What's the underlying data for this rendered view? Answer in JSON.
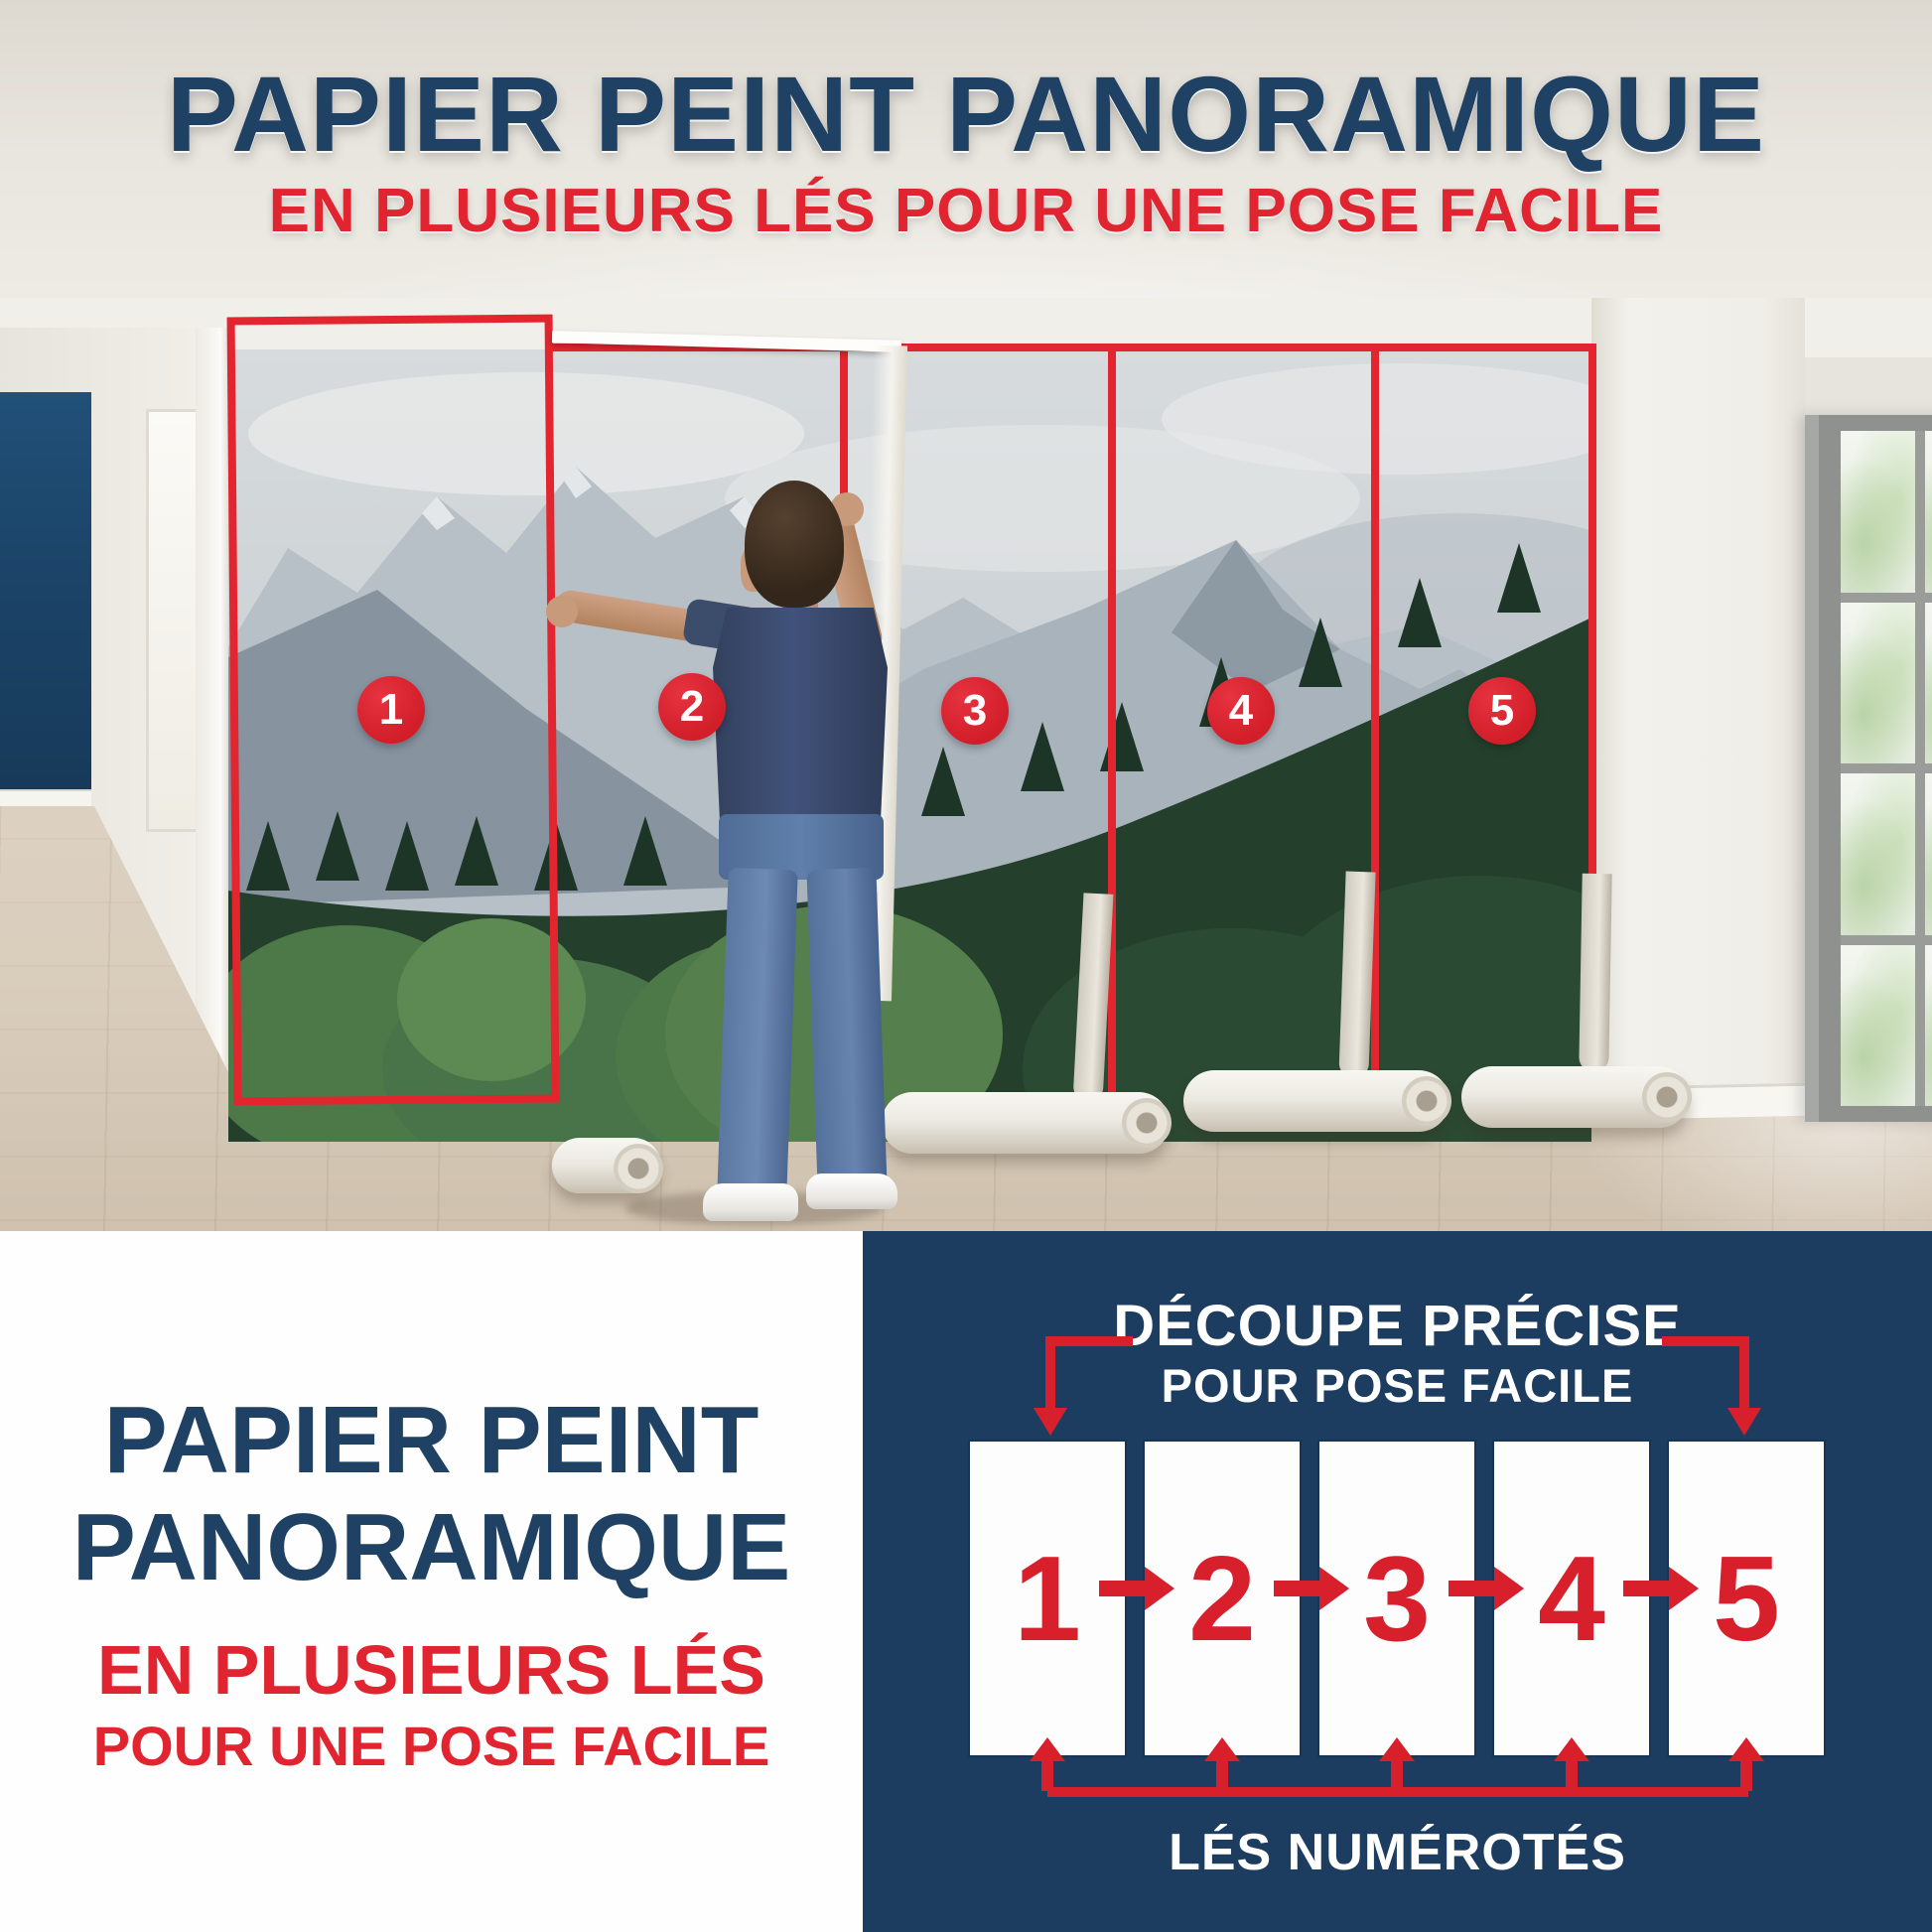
{
  "header": {
    "title": "PAPIER PEINT PANORAMIQUE",
    "subtitle": "EN PLUSIEURS LÉS POUR UNE POSE FACILE"
  },
  "photo": {
    "panel_markers": [
      "1",
      "2",
      "3",
      "4",
      "5"
    ]
  },
  "bottom_left": {
    "title_line1": "PAPIER PEINT",
    "title_line2": "PANORAMIQUE",
    "subtitle_line1": "EN PLUSIEURS LÉS",
    "subtitle_line2": "POUR UNE POSE FACILE"
  },
  "diagram": {
    "header_line1": "DÉCOUPE PRÉCISE",
    "header_line2": "POUR POSE FACILE",
    "panels": [
      "1",
      "2",
      "3",
      "4",
      "5"
    ],
    "footer": "LÉS NUMÉROTÉS"
  },
  "colors": {
    "title_navy": "#1e4164",
    "accent_red": "#e02530",
    "marker_red": "#d8202c",
    "panel_navy": "#1c3d5f",
    "white": "#ffffff"
  }
}
